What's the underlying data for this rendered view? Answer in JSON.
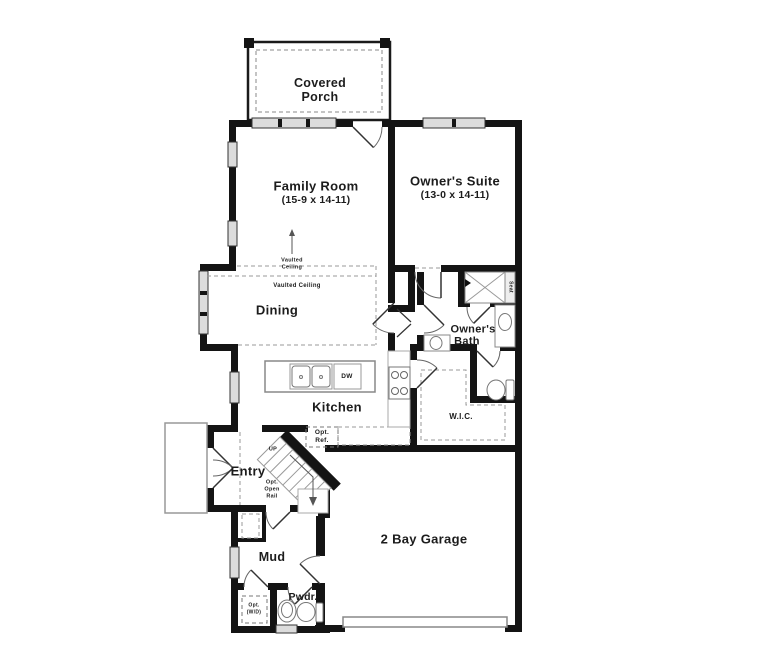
{
  "rooms": {
    "covered_porch": {
      "line1": "Covered",
      "line2": "Porch"
    },
    "family_room": {
      "name": "Family Room",
      "dims": "(15-9 x 14-11)"
    },
    "owners_suite": {
      "name": "Owner's Suite",
      "dims": "(13-0 x 14-11)"
    },
    "dining": {
      "name": "Dining"
    },
    "kitchen": {
      "name": "Kitchen"
    },
    "owners_bath": {
      "line1": "Owner's",
      "line2": "Bath"
    },
    "wic": {
      "name": "W.I.C."
    },
    "entry": {
      "name": "Entry"
    },
    "mud": {
      "name": "Mud"
    },
    "pwdr": {
      "name": "Pwdr."
    },
    "garage": {
      "name": "2 Bay Garage"
    }
  },
  "annotations": {
    "vaulted_family": {
      "line1": "Vaulted",
      "line2": "Ceiling"
    },
    "vaulted_dining": "Vaulted Ceiling",
    "stairs_up": "UP",
    "opt_open_rail": {
      "line1": "Opt.",
      "line2": "Open",
      "line3": "Rail"
    },
    "opt_ref": {
      "line1": "Opt.",
      "line2": "Ref."
    },
    "opt_wd": {
      "line1": "Opt.",
      "line2": "(W/D)"
    },
    "dishwasher": "DW",
    "shower_seat": "Seat"
  },
  "colors": {
    "wall": "#141414",
    "window_fill": "#dcdcdc",
    "dashed_line": "#9a9a9a",
    "fixture_line": "#777777",
    "background": "#ffffff"
  }
}
